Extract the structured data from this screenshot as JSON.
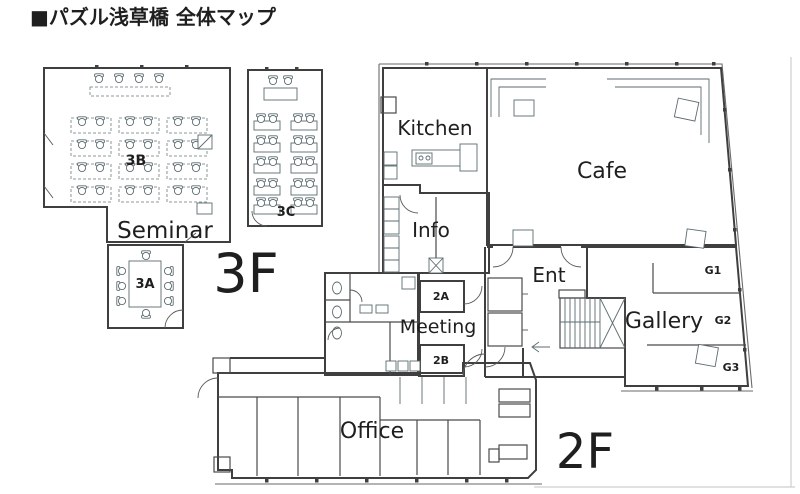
{
  "title": "■パズル浅草橋 全体マップ",
  "floor3": {
    "label": "3F",
    "seminar": "Seminar",
    "room_3b": "3B",
    "room_3c": "3C",
    "room_3a": "3A"
  },
  "floor2": {
    "label": "2F",
    "kitchen": "Kitchen",
    "cafe": "Cafe",
    "info": "Info",
    "entrance": "Ent",
    "gallery": "Gallery",
    "gallery_zones": {
      "g1": "G1",
      "g2": "G2",
      "g3": "G3"
    },
    "meeting": "Meeting",
    "room_2a": "2A",
    "room_2b": "2B",
    "office": "Office"
  },
  "colors": {
    "classroom_cyan": "#d7f3f4",
    "meeting_cyan": "#c9edf2",
    "kitchen_pink": "#f5c9c9",
    "cafe_yellow": "#f8f3c5",
    "info_green": "#ccecc6",
    "gallery_pink": "#f6c2da",
    "office_lavender": "#c9c6ed",
    "wall": "#3f3f3f"
  }
}
